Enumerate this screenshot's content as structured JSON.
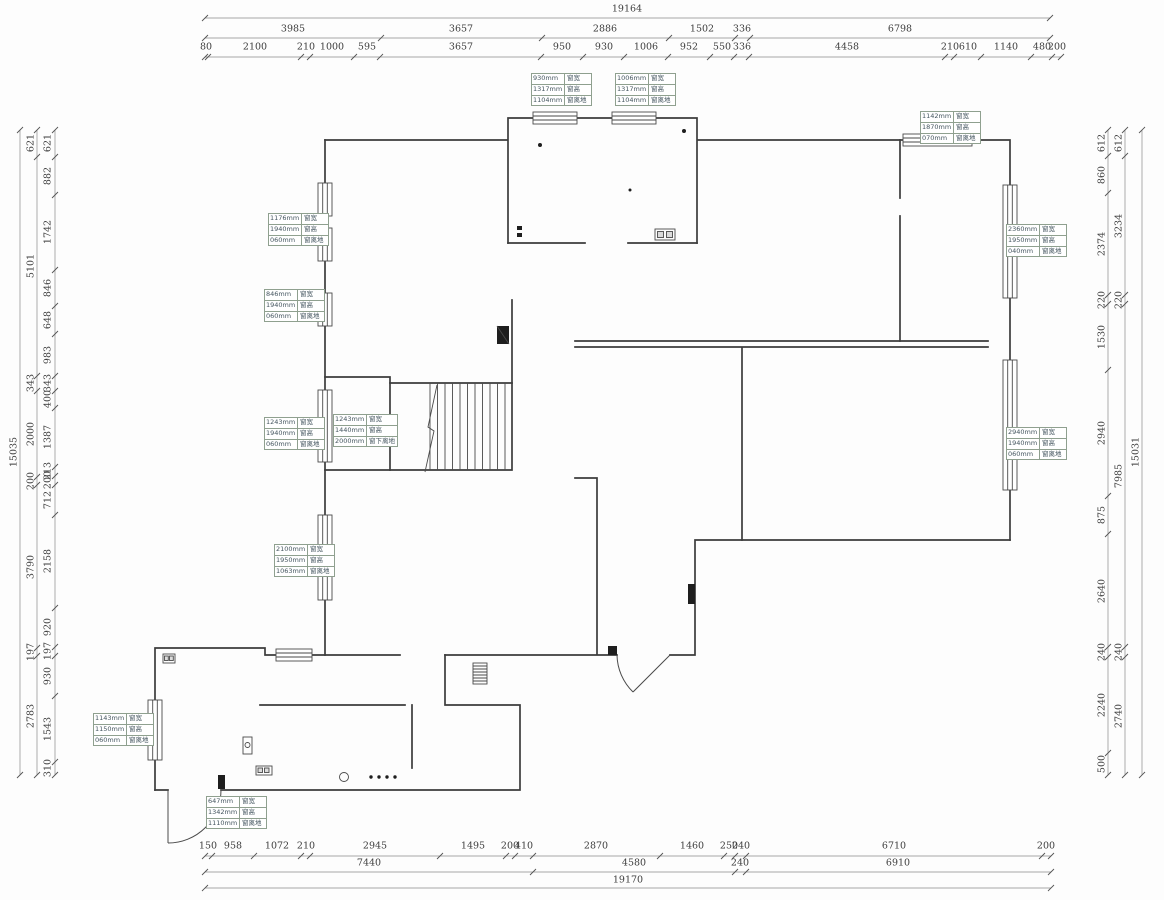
{
  "dims": {
    "top": {
      "row1": [
        "19164"
      ],
      "row2": [
        "3985",
        "3657",
        "2886",
        "1502",
        "336",
        "6798"
      ],
      "row3": [
        "80",
        "2100",
        "210",
        "1000",
        "595",
        "3657",
        "950",
        "930",
        "1006",
        "952",
        "550",
        "336",
        "4458",
        "210",
        "610",
        "1140",
        "480",
        "200"
      ]
    },
    "bottom": {
      "row1": [
        "150",
        "958",
        "1072",
        "210",
        "2945",
        "1495",
        "200",
        "410",
        "2870",
        "1460",
        "250",
        "240",
        "6710",
        "200"
      ],
      "row2": [
        "7440",
        "4580",
        "240",
        "6910"
      ],
      "row3": [
        "19170"
      ]
    },
    "left": {
      "outer": [
        "15035"
      ],
      "middle": [
        "621",
        "5101",
        "343",
        "2000",
        "200",
        "3790",
        "197",
        "2783"
      ],
      "inner": [
        "621",
        "882",
        "1742",
        "846",
        "648",
        "983",
        "343",
        "400",
        "1387",
        "213",
        "200",
        "712",
        "2158",
        "920",
        "197",
        "930",
        "1543",
        "310"
      ]
    },
    "right": {
      "outer": [
        "15031"
      ],
      "middle": [
        "612",
        "3234",
        "220",
        "7985",
        "240",
        "2740"
      ],
      "inner": [
        "612",
        "860",
        "2374",
        "220",
        "1530",
        "2940",
        "875",
        "2640",
        "240",
        "2240",
        "500"
      ]
    }
  },
  "window_labels": [
    {
      "rows": [
        [
          "1176mm",
          "窗宽"
        ],
        [
          "1940mm",
          "窗高"
        ],
        [
          "060mm",
          "窗离地"
        ]
      ]
    },
    {
      "rows": [
        [
          "846mm",
          "窗宽"
        ],
        [
          "1940mm",
          "窗高"
        ],
        [
          "060mm",
          "窗离地"
        ]
      ]
    },
    {
      "rows": [
        [
          "1243mm",
          "窗宽"
        ],
        [
          "1940mm",
          "窗高"
        ],
        [
          "060mm",
          "窗离地"
        ]
      ]
    },
    {
      "rows": [
        [
          "1243mm",
          "窗宽"
        ],
        [
          "1440mm",
          "窗高"
        ],
        [
          "2000mm",
          "窗下离地"
        ]
      ]
    },
    {
      "rows": [
        [
          "2100mm",
          "窗宽"
        ],
        [
          "1950mm",
          "窗高"
        ],
        [
          "1063mm",
          "窗离地"
        ]
      ]
    },
    {
      "rows": [
        [
          "930mm",
          "窗宽"
        ],
        [
          "1317mm",
          "窗高"
        ],
        [
          "1104mm",
          "窗离地"
        ]
      ]
    },
    {
      "rows": [
        [
          "1006mm",
          "窗宽"
        ],
        [
          "1317mm",
          "窗高"
        ],
        [
          "1104mm",
          "窗离地"
        ]
      ]
    },
    {
      "rows": [
        [
          "1142mm",
          "窗宽"
        ],
        [
          "1870mm",
          "窗高"
        ],
        [
          "070mm",
          "窗离地"
        ]
      ]
    },
    {
      "rows": [
        [
          "2360mm",
          "窗宽"
        ],
        [
          "1950mm",
          "窗高"
        ],
        [
          "040mm",
          "窗离地"
        ]
      ]
    },
    {
      "rows": [
        [
          "2940mm",
          "窗宽"
        ],
        [
          "1940mm",
          "窗高"
        ],
        [
          "060mm",
          "窗离地"
        ]
      ]
    },
    {
      "rows": [
        [
          "1143mm",
          "窗宽"
        ],
        [
          "1150mm",
          "窗高"
        ],
        [
          "060mm",
          "窗离地"
        ]
      ]
    },
    {
      "rows": [
        [
          "647mm",
          "窗宽"
        ],
        [
          "1342mm",
          "窗高"
        ],
        [
          "1110mm",
          "窗离地"
        ]
      ]
    }
  ]
}
